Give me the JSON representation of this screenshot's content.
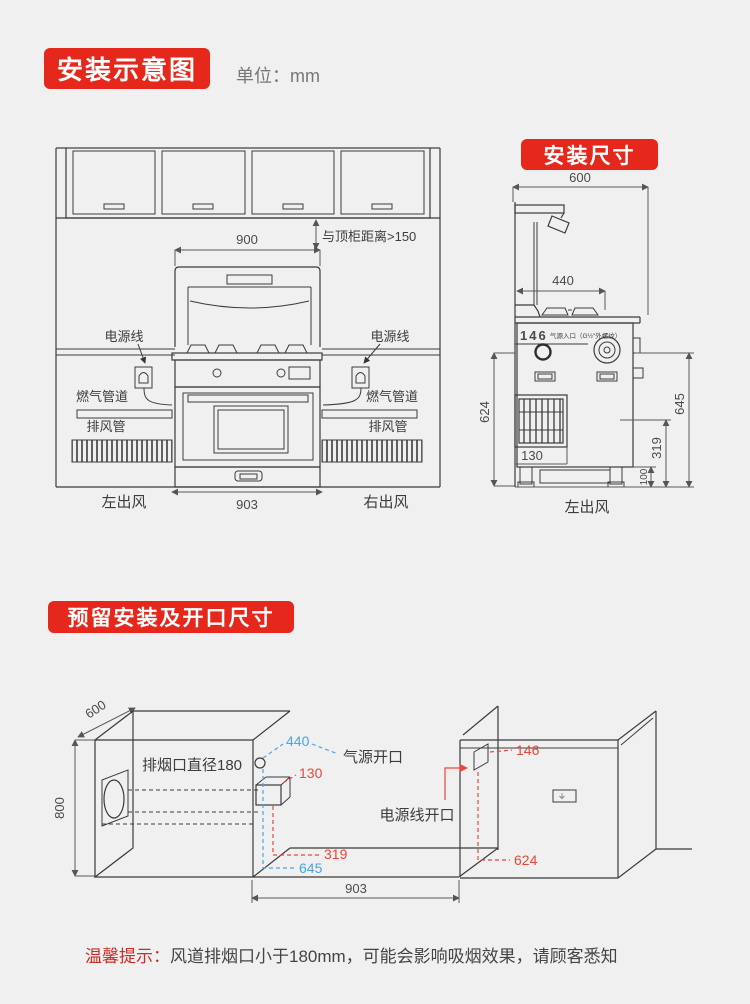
{
  "header": {
    "badge": "安装示意图",
    "unit": "单位：mm"
  },
  "front": {
    "gap_note": "与顶柜距离>150",
    "dim_top": "900",
    "dim_bottom": "903",
    "power_cord": "电源线",
    "gas_pipe": "燃气管道",
    "exhaust_pipe": "排风管",
    "outlet_left": "左出风",
    "outlet_right": "右出风"
  },
  "side": {
    "badge": "安装尺寸",
    "dim_width": "600",
    "dim_burner": "440",
    "dim_gas": "146",
    "gas_note": "气源入口（G½″外螺纹）",
    "dim_left": "624",
    "dim_box": "130",
    "dim_right": "645",
    "dim_319": "319",
    "dim_100": "100",
    "outlet": "左出风"
  },
  "opening": {
    "badge": "预留安装及开口尺寸",
    "dim_depth": "600",
    "dim_height": "800",
    "duct_label": "排烟口直径180",
    "dim_440": "440",
    "gas_label": "气源开口",
    "dim_130": "130",
    "dim_319": "319",
    "dim_645": "645",
    "dim_903": "903",
    "power_label": "电源线开口",
    "dim_146": "146",
    "dim_624": "624"
  },
  "note": {
    "prefix": "温馨提示：",
    "body": "风道排烟口小于180mm，可能会影响吸烟效果，请顾客悉知"
  },
  "colors": {
    "accent_red": "#e5271c",
    "dim_red": "#e8483b",
    "dim_blue": "#48a7e1"
  }
}
